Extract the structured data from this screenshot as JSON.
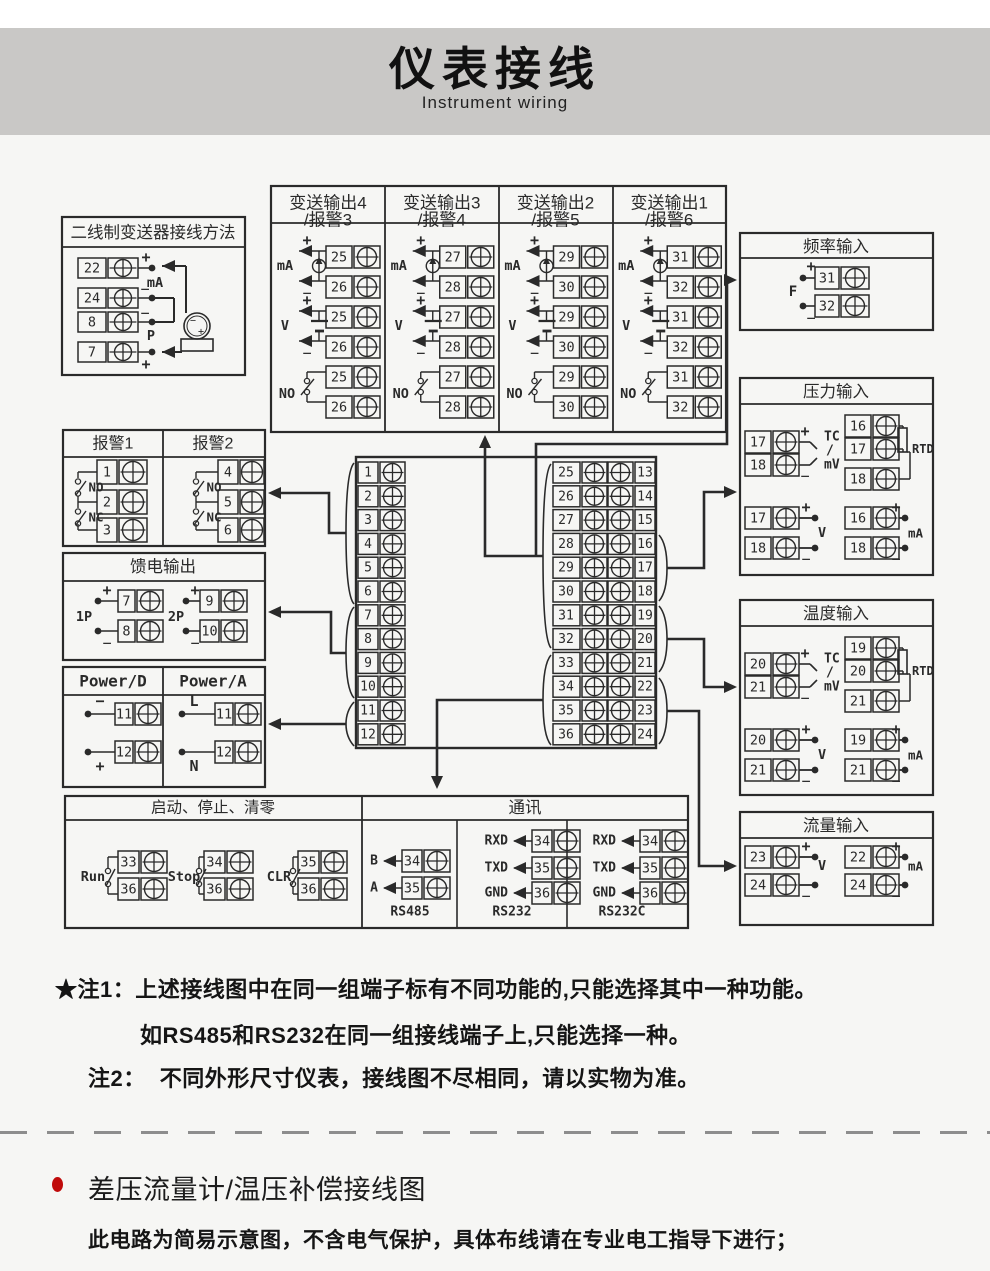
{
  "colors": {
    "banner_bg": "#c9c8c6",
    "line": "#2a2a2a",
    "page_bg": "#f6f6f4",
    "bullet_red": "#c00b0b"
  },
  "banner": {
    "title": "仪表接线",
    "subtitle": "Instrument wiring"
  },
  "notes": [
    {
      "prefix": "★注1：",
      "text": "上述接线图中在同一组端子标有不同功能的,只能选择其中一种功能。"
    },
    {
      "prefix": "",
      "text": "如RS485和RS232在同一组接线端子上,只能选择一种。"
    },
    {
      "prefix": "注2：",
      "text": "不同外形尺寸仪表，接线图不尽相同，请以实物为准。"
    }
  ],
  "footer": {
    "heading": "差压流量计/温压补偿接线图",
    "body": "此电路为简易示意图，不含电气保护，具体布线请在专业电工指导下进行；"
  },
  "diagram": {
    "two_wire": {
      "title": "二线制变送器接线方法",
      "rows": [
        {
          "num": "22",
          "sign": "+"
        },
        {
          "num": "24",
          "sign": "−"
        },
        {
          "num": "8",
          "sign": "−"
        },
        {
          "num": "7",
          "sign": "+"
        }
      ],
      "label_ma": "mA",
      "label_p": "P",
      "transmitter": {
        "minus": "−",
        "plus": "+"
      }
    },
    "xmit": {
      "columns": [
        {
          "title": "变送输出4",
          "subtitle": "/报警3",
          "t1": "25",
          "t2": "26"
        },
        {
          "title": "变送输出3",
          "subtitle": "/报警4",
          "t1": "27",
          "t2": "28"
        },
        {
          "title": "变送输出2",
          "subtitle": "/报警5",
          "t1": "29",
          "t2": "30"
        },
        {
          "title": "变送输出1",
          "subtitle": "/报警6",
          "t1": "31",
          "t2": "32"
        }
      ],
      "label_ma": "mA",
      "label_v": "V",
      "label_no": "NO",
      "plus": "+",
      "minus": "−"
    },
    "freq": {
      "title": "频率输入",
      "label": "F",
      "rows": [
        {
          "num": "31",
          "sign": "+"
        },
        {
          "num": "32",
          "sign": "−"
        }
      ]
    },
    "alarm": {
      "no": "NO",
      "nc": "NC",
      "cols": [
        {
          "title": "报警1",
          "terms": [
            "1",
            "2",
            "3"
          ]
        },
        {
          "title": "报警2",
          "terms": [
            "4",
            "5",
            "6"
          ]
        }
      ]
    },
    "feed": {
      "title": "馈电输出",
      "groups": [
        {
          "label": "1P",
          "rows": [
            {
              "num": "7",
              "sign": "+"
            },
            {
              "num": "8",
              "sign": "−"
            }
          ]
        },
        {
          "label": "2P",
          "rows": [
            {
              "num": "9",
              "sign": "+"
            },
            {
              "num": "10",
              "sign": "−"
            }
          ]
        }
      ]
    },
    "power": {
      "cols": [
        {
          "title": "Power/D",
          "rows": [
            {
              "num": "11",
              "sign": "−"
            },
            {
              "num": "12",
              "sign": "+"
            }
          ]
        },
        {
          "title": "Power/A",
          "rows": [
            {
              "num": "11",
              "sign": "L"
            },
            {
              "num": "12",
              "sign": "N"
            }
          ]
        }
      ]
    },
    "center": {
      "left": [
        "1",
        "2",
        "3",
        "4",
        "5",
        "6",
        "7",
        "8",
        "9",
        "10",
        "11",
        "12"
      ],
      "mid": [
        "25",
        "26",
        "27",
        "28",
        "29",
        "30",
        "31",
        "32",
        "33",
        "34",
        "35",
        "36"
      ],
      "right": [
        "13",
        "14",
        "15",
        "16",
        "17",
        "18",
        "19",
        "20",
        "21",
        "22",
        "23",
        "24"
      ]
    },
    "pressure": {
      "title": "压力输入",
      "tc": {
        "rows": [
          {
            "num": "17",
            "sign": "+"
          },
          {
            "num": "18",
            "sign": "−"
          }
        ],
        "labels": [
          "TC",
          "/",
          "mV"
        ]
      },
      "rtd": {
        "terms": [
          "16",
          "17",
          "18"
        ],
        "label": "RTD"
      },
      "v": {
        "rows": [
          {
            "num": "17",
            "sign": "+"
          },
          {
            "num": "18",
            "sign": "−"
          }
        ],
        "label": "V"
      },
      "ma": {
        "rows": [
          {
            "num": "16",
            "sign": "+"
          },
          {
            "num": "18",
            "sign": "−"
          }
        ],
        "label": "mA"
      }
    },
    "temp": {
      "title": "温度输入",
      "tc": {
        "rows": [
          {
            "num": "20",
            "sign": "+"
          },
          {
            "num": "21",
            "sign": "−"
          }
        ],
        "labels": [
          "TC",
          "/",
          "mV"
        ]
      },
      "rtd": {
        "terms": [
          "19",
          "20",
          "21"
        ],
        "label": "RTD"
      },
      "v": {
        "rows": [
          {
            "num": "20",
            "sign": "+"
          },
          {
            "num": "21",
            "sign": "−"
          }
        ],
        "label": "V"
      },
      "ma": {
        "rows": [
          {
            "num": "19",
            "sign": "+"
          },
          {
            "num": "21",
            "sign": "−"
          }
        ],
        "label": "mA"
      }
    },
    "flow": {
      "title": "流量输入",
      "v": {
        "rows": [
          {
            "num": "23",
            "sign": "+"
          },
          {
            "num": "24",
            "sign": "−"
          }
        ],
        "label": "V"
      },
      "ma": {
        "rows": [
          {
            "num": "22",
            "sign": "+"
          },
          {
            "num": "24",
            "sign": "−"
          }
        ],
        "label": "mA"
      }
    },
    "runstop": {
      "title": "启动、停止、清零",
      "switches": [
        {
          "label": "Run",
          "t1": "33",
          "t2": "36"
        },
        {
          "label": "Stop",
          "t1": "34",
          "t2": "36"
        },
        {
          "label": "CLR",
          "t1": "35",
          "t2": "36"
        }
      ]
    },
    "comm": {
      "title": "通讯",
      "sections": [
        {
          "name": "RS485",
          "rows": [
            {
              "sig": "B",
              "num": "34"
            },
            {
              "sig": "A",
              "num": "35"
            }
          ]
        },
        {
          "name": "RS232",
          "rows": [
            {
              "sig": "RXD",
              "num": "34"
            },
            {
              "sig": "TXD",
              "num": "35"
            },
            {
              "sig": "GND",
              "num": "36"
            }
          ]
        },
        {
          "name": "RS232C",
          "rows": [
            {
              "sig": "RXD",
              "num": "34"
            },
            {
              "sig": "TXD",
              "num": "35"
            },
            {
              "sig": "GND",
              "num": "36"
            }
          ]
        }
      ]
    }
  }
}
